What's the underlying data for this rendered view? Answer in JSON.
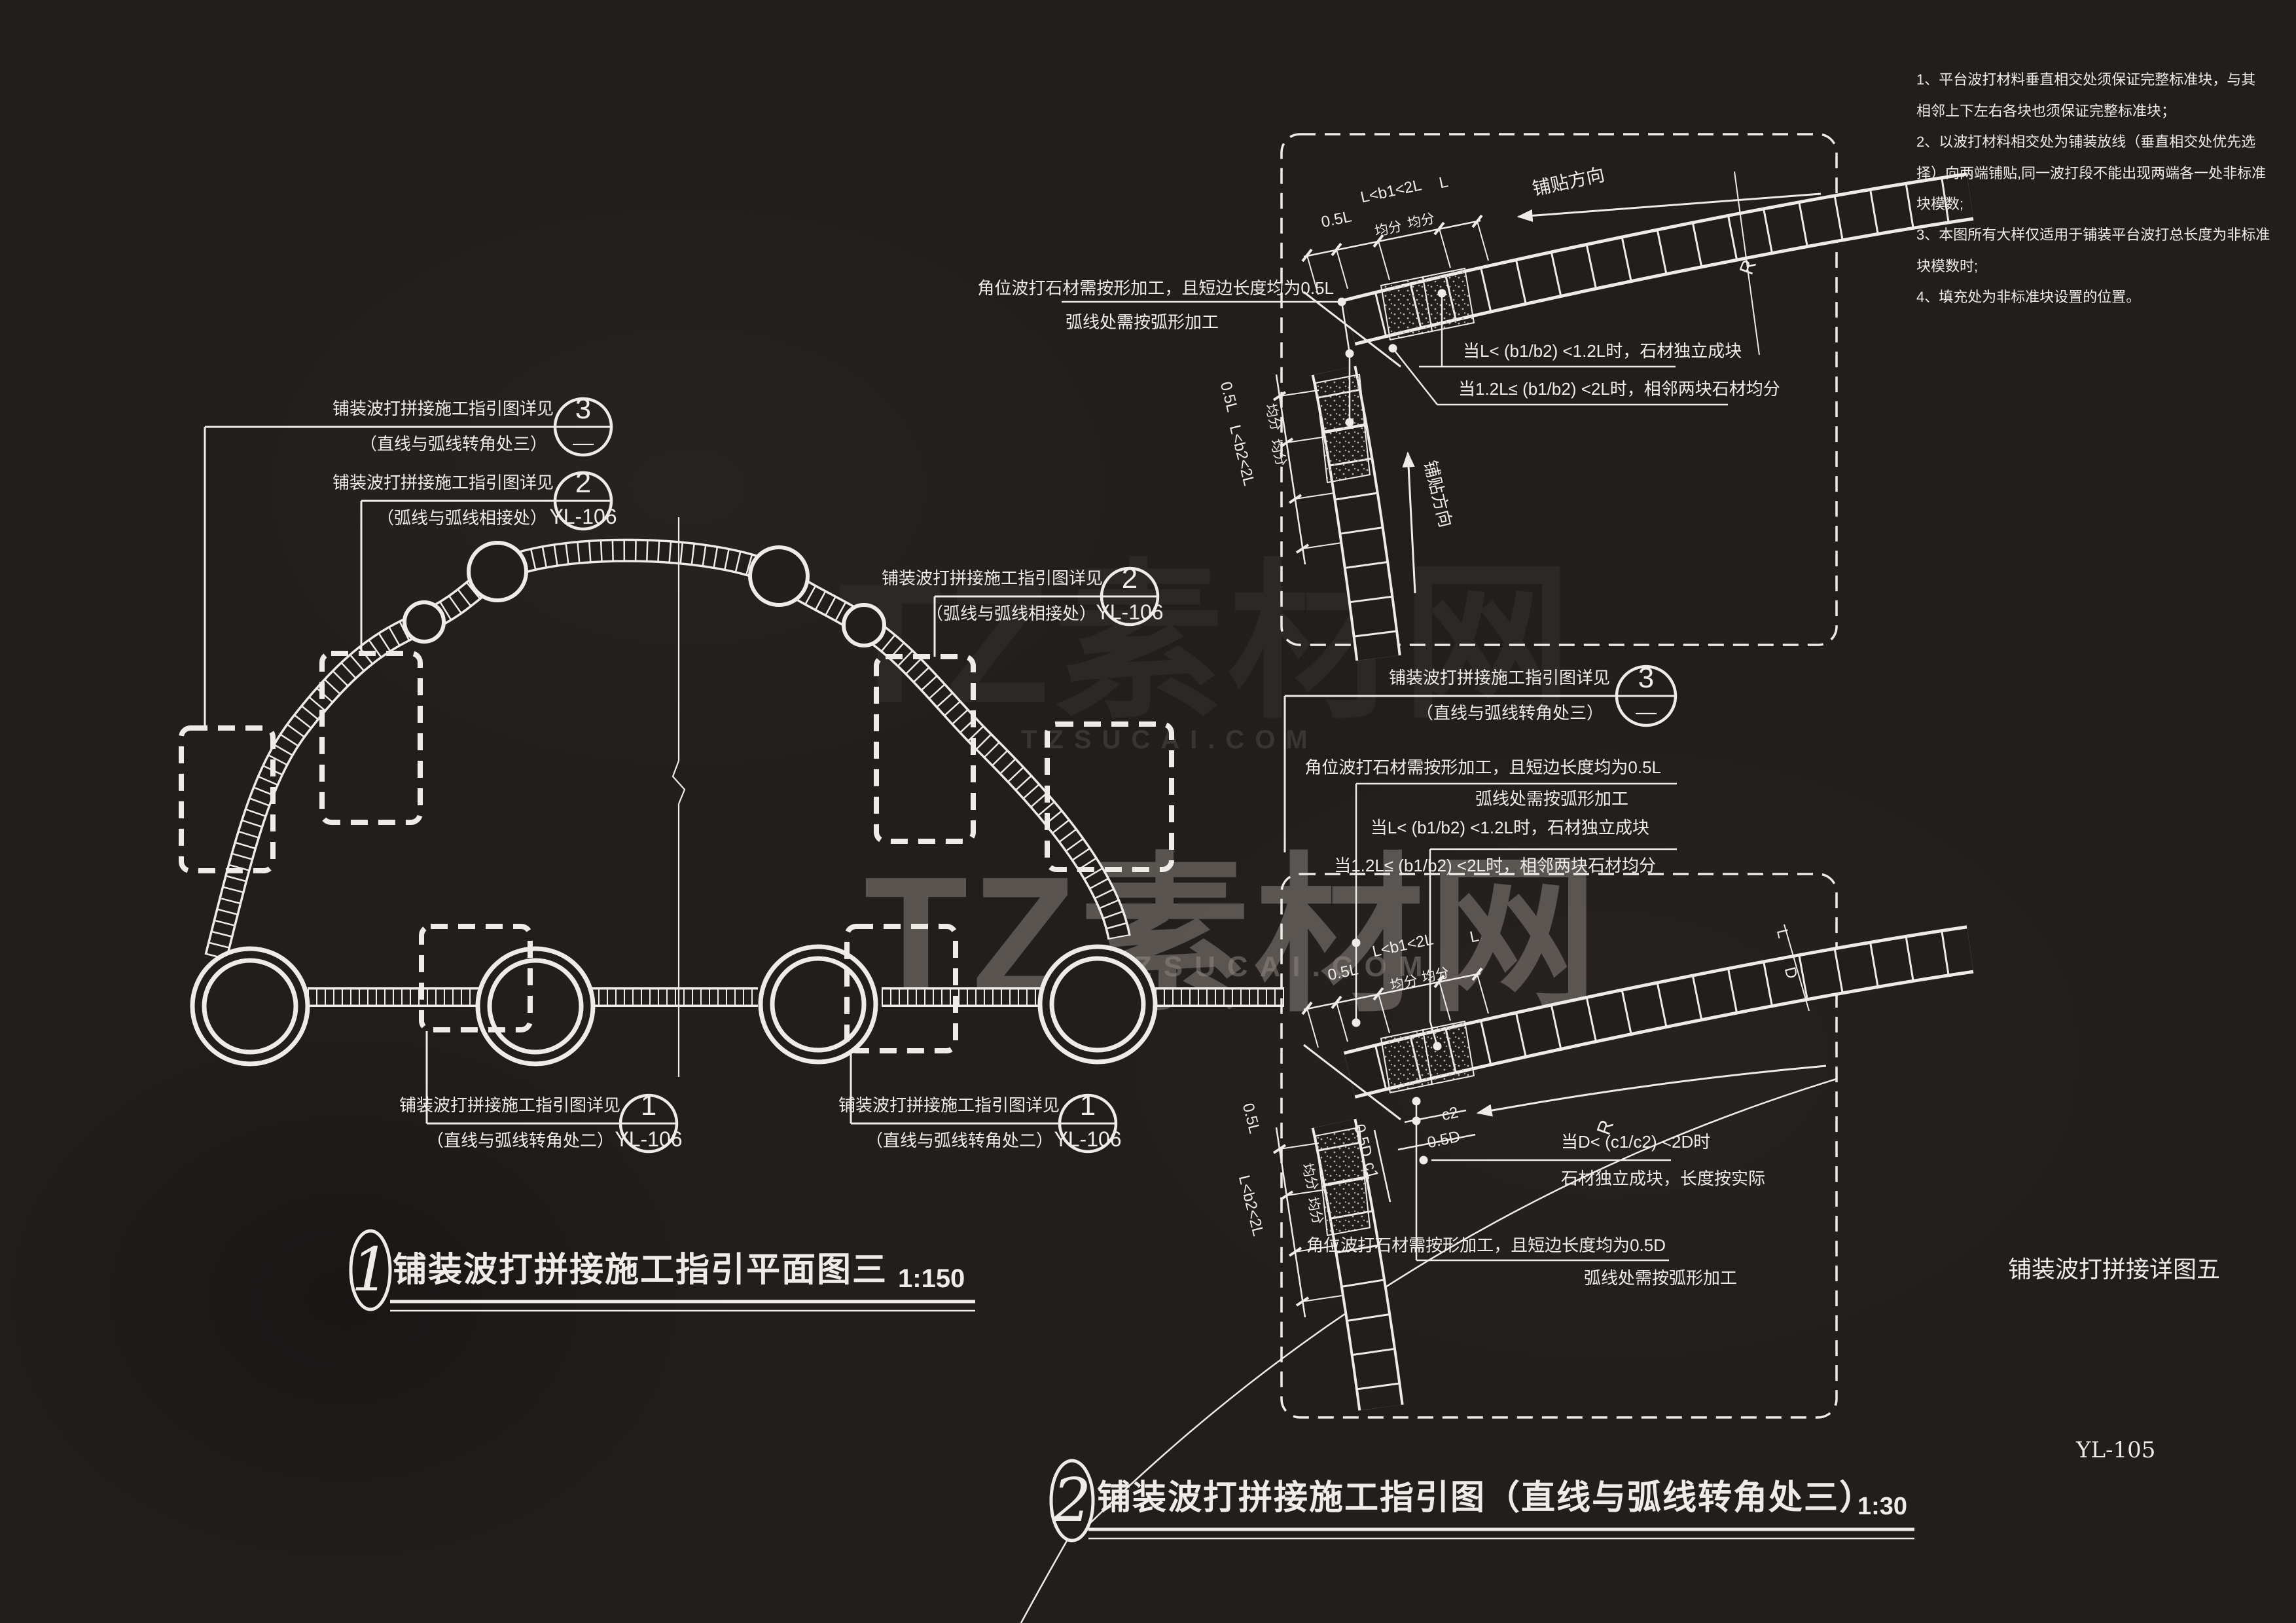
{
  "sheet": {
    "number": "YL-105",
    "footer_title": "铺装波打拼接详图五",
    "bg": "#211e1d",
    "line_color": "#efece8"
  },
  "watermark": {
    "brand": "TZ素材网",
    "domain": "TZSUCAI.COM"
  },
  "notes": {
    "lines": [
      "1、平台波打材料垂直相交处须保证完整标准块，与其",
      "相邻上下左右各块也须保证完整标准块；",
      "2、以波打材料相交处为铺装放线（垂直相交处优先选",
      "择）向两端铺贴,同一波打段不能出现两端各一处非标准",
      "块模数;",
      "3、本图所有大样仅适用于铺装平台波打总长度为非标准",
      "块模数时;",
      "4、填充处为非标准块设置的位置。"
    ]
  },
  "titles": {
    "t1": {
      "num": "1",
      "text": "铺装波打拼接施工指引平面图三",
      "scale": "1:150"
    },
    "t2": {
      "num": "2",
      "text": "铺装波打拼接施工指引图（直线与弧线转角处三）",
      "scale": "1:30"
    }
  },
  "callouts": {
    "see": "铺装波打拼接施工指引图详见",
    "a": {
      "sub": "（直线与弧线转角处三）",
      "num": "3",
      "ref": "—"
    },
    "b": {
      "sub": "（弧线与弧线相接处）",
      "num": "2",
      "ref": "YL-106"
    },
    "c": {
      "sub": "（弧线与弧线相接处）",
      "num": "2",
      "ref": "YL-106"
    },
    "d": {
      "sub": "（直线与弧线转角处三）",
      "num": "3",
      "ref": "—"
    },
    "e": {
      "sub": "（直线与弧线转角处二）",
      "num": "1",
      "ref": "YL-106"
    },
    "f": {
      "sub": "（直线与弧线转角处二）",
      "num": "1",
      "ref": "YL-106"
    }
  },
  "dims": {
    "half_l": "0.5L",
    "b1": "L<b1<2L",
    "len": "L",
    "avg": "均分",
    "b2": "L<b2<2L",
    "r": "R",
    "c1": "c1",
    "c2": "c2",
    "half_d": "0.5D",
    "d": "D",
    "dir": "铺贴方向"
  },
  "detail_top": {
    "corner_note1": "角位波打石材需按形加工，且短边长度均为0.5L",
    "corner_note2": "弧线处需按弧形加工",
    "cond1": "当L< (b1/b2) <1.2L时，石材独立成块",
    "cond2": "当1.2L≤ (b1/b2) <2L时，相邻两块石材均分"
  },
  "detail_bottom": {
    "top_note1": "角位波打石材需按形加工，且短边长度均为0.5L",
    "top_note2": "弧线处需按弧形加工",
    "cond1": "当L< (b1/b2) <1.2L时，石材独立成块",
    "cond2": "当1.2L≤ (b1/b2) <2L时，相邻两块石材均分",
    "cond3": "当D< (c1/c2) <2D时",
    "cond4": "石材独立成块，长度按实际",
    "corner_note1": "角位波打石材需按形加工，且短边长度均为0.5D",
    "corner_note2": "弧线处需按弧形加工"
  }
}
